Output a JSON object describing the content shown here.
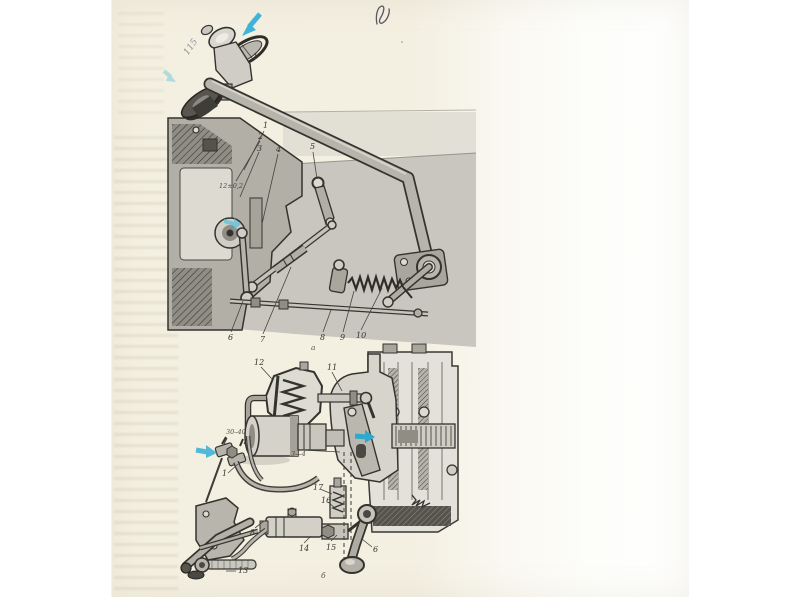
{
  "document": {
    "kind": "scanned technical manual page with two mechanism figures"
  },
  "marginalia": {
    "handwritten_number": "115",
    "pen_mark": "V"
  },
  "upper_figure": {
    "subject": "gear-shift lever and linkage mechanism",
    "knob_callout": {
      "label": "1"
    },
    "callouts": [
      {
        "label": "1"
      },
      {
        "label": "2"
      },
      {
        "label": "3"
      },
      {
        "label": "4"
      },
      {
        "label": "5"
      },
      {
        "label": "6"
      },
      {
        "label": "7"
      },
      {
        "label": "8"
      },
      {
        "label": "9"
      },
      {
        "label": "10"
      }
    ],
    "dimension": {
      "label": "12±0,2"
    },
    "view_label": {
      "label": "а"
    }
  },
  "lower_figure": {
    "subject": "clutch release servo and gearbox cross-section",
    "callouts": [
      {
        "label": "12"
      },
      {
        "label": "11"
      },
      {
        "label": "1"
      },
      {
        "label": "17"
      },
      {
        "label": "16"
      },
      {
        "label": "8"
      },
      {
        "label": "14"
      },
      {
        "label": "15"
      },
      {
        "label": "6"
      },
      {
        "label": "13"
      }
    ],
    "dimension": {
      "label": "30–40"
    },
    "gap_dimension": {
      "label": "3—4"
    },
    "view_label": {
      "label": "б"
    }
  },
  "colors": {
    "page_cream": "#f4f0e1",
    "diagram_wash": "#c8c6be",
    "ink": "#35342f",
    "highlight_arrow": "#3fb3d8"
  }
}
